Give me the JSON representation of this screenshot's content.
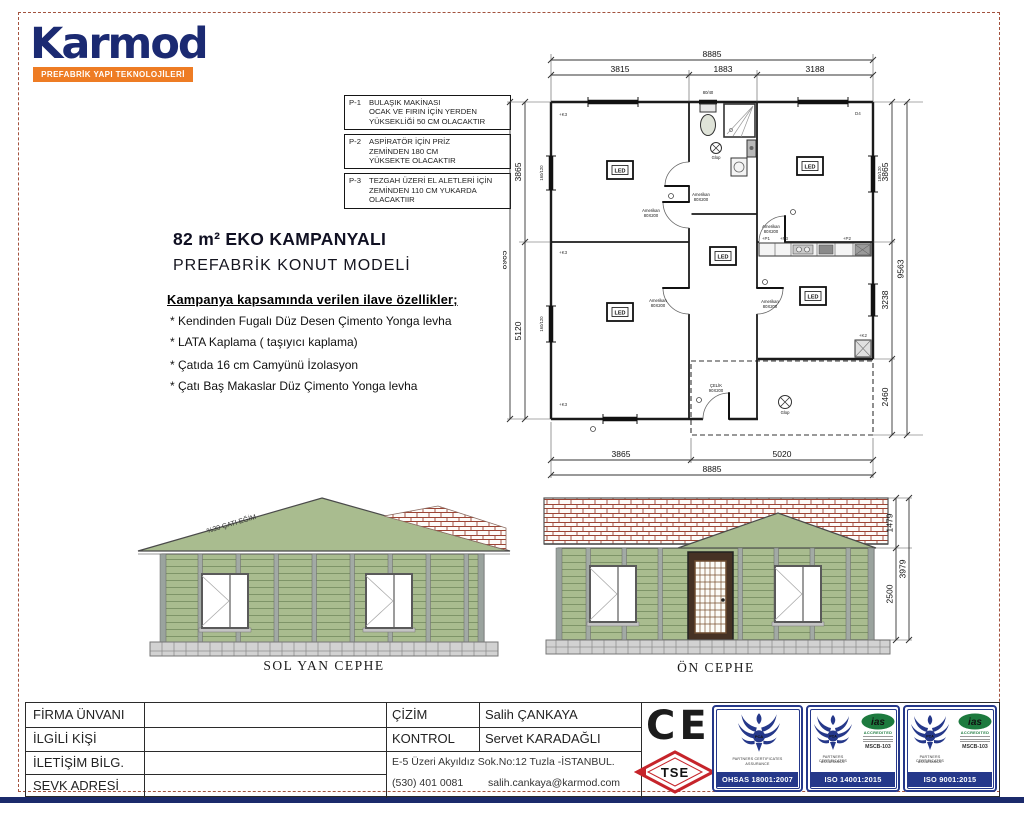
{
  "colors": {
    "navy": "#1b2a6e",
    "orange": "#ee7c24",
    "siding_green": "#a9bc8f",
    "tile_red": "#9c4434",
    "badge_blue": "#25388a",
    "ias_green": "#1d7a3e",
    "tse_red": "#c6242b"
  },
  "logo": {
    "name": "Karmod",
    "tagline": "PREFABRİK YAPI TEKNOLOJİLERİ"
  },
  "notes": [
    {
      "id": "P-1",
      "line1": "BULAŞIK MAKİNASI",
      "line2": "OCAK VE FIRIN İÇİN  YERDEN",
      "line3": "YÜKSEKLİĞİ 50 CM OLACAKTIR"
    },
    {
      "id": "P-2",
      "line1": "ASPİRATÖR İÇİN  PRİZ",
      "line2": "ZEMİNDEN 180 CM",
      "line3": "YÜKSEKTE OLACAKTIR"
    },
    {
      "id": "P-3",
      "line1": "TEZGAH ÜZERİ EL ALETLERİ İÇİN",
      "line2": "ZEMİNDEN 110 CM YUKARDA",
      "line3": "OLACAKTIIR"
    }
  ],
  "title": {
    "line1": "82 m²  EKO KAMPANYALI",
    "line2": "PREFABRİK KONUT MODELİ"
  },
  "features": {
    "heading": "Kampanya kapsamında verilen ilave özellikler;",
    "items": [
      "* Kendinden Fugalı Düz Desen Çimento Yonga levha",
      "* LATA Kaplama ( taşıyıcı kaplama)",
      "* Çatıda 16 cm Camyünü İzolasyon",
      "* Çatı Baş Makaslar Düz  Çimento Yonga levha"
    ]
  },
  "plan": {
    "dims": {
      "top_total": "8885",
      "top_segments": [
        "3815",
        "1883",
        "3188"
      ],
      "bottom_segments": [
        "3865",
        "5020"
      ],
      "bottom_total": "8885",
      "left_segments": [
        "3865",
        "5120"
      ],
      "left_total": "8985",
      "right_segments": [
        "3865",
        "3238",
        "2460"
      ],
      "right_total": "9563"
    },
    "window_dims": {
      "left": "160/120",
      "right": "180/120",
      "bath": "80/40"
    },
    "labels": {
      "door_brand": "Amerikan",
      "door_size": "80X200",
      "entry_brand": "ÇELİK",
      "entry_size": "90X200",
      "led": "LED",
      "lamp": "Glop"
    },
    "marks": {
      "k3": "+K3",
      "d4": "D4",
      "k2": "+K2",
      "p1": "+P1",
      "p2": "+P2",
      "p3": "+P3"
    }
  },
  "elevations": {
    "left": {
      "label": "SOL YAN CEPHE",
      "roof_note": "%30 ÇATI EĞİM"
    },
    "front": {
      "label": "ÖN CEPHE",
      "dim_roof": "1479",
      "dim_wall": "2500",
      "dim_total": "3979"
    }
  },
  "info_table": {
    "rows": [
      "FİRMA ÜNVANI",
      "İLGİLİ KİŞİ",
      "İLETİŞİM BİLG.",
      "SEVK ADRESİ"
    ],
    "cizim_label": "ÇİZİM",
    "cizim_value": "Salih ÇANKAYA",
    "kontrol_label": "KONTROL",
    "kontrol_value": "Servet KARADAĞLI",
    "address": "E-5 Üzeri Akyıldız Sok.No:12 Tuzla -İSTANBUL.",
    "phone": "(530) 401 0081",
    "email": "salih.cankaya@karmod.com"
  },
  "certs": {
    "ce": "CE",
    "tse": "TSE",
    "pca": "PCA",
    "partner_line1": "PARTNERS CERTIFICATES",
    "partner_line2": "ASSURANCE",
    "ias": "ias",
    "accredited": "ACCREDITED",
    "mscb": "MSCB-103",
    "badges": [
      "OHSAS 18001:2007",
      "ISO 14001:2015",
      "ISO 9001:2015"
    ]
  }
}
